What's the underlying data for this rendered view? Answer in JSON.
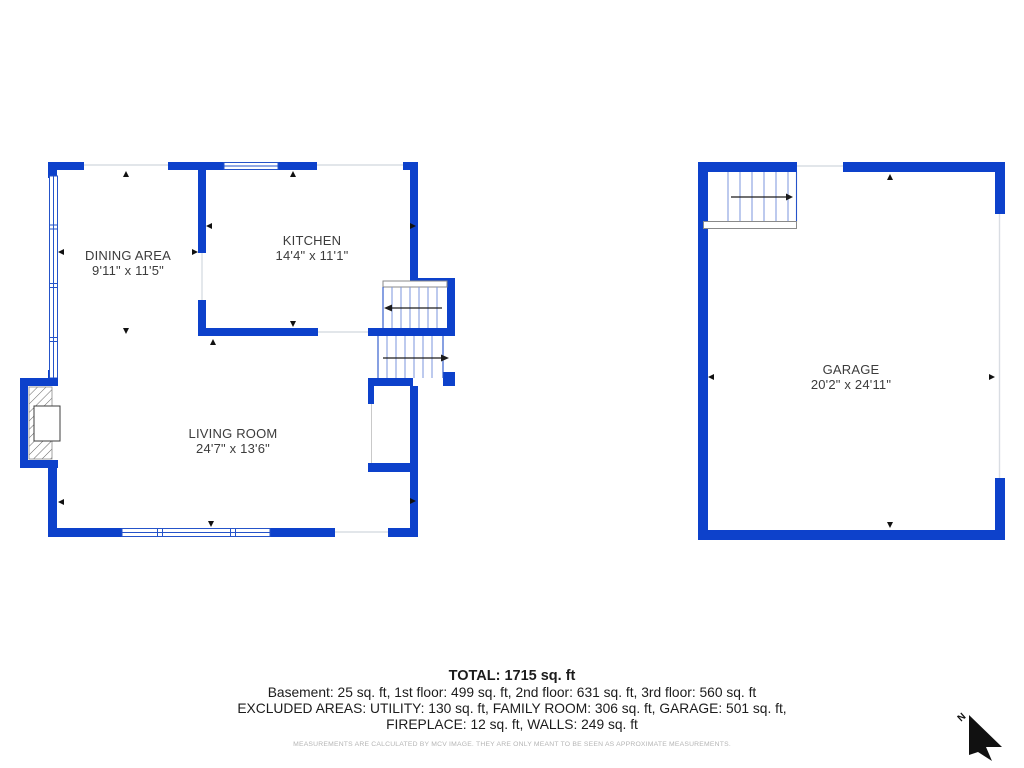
{
  "colors": {
    "wall": "#0d41cb",
    "windowline": "#2553c9",
    "tread": "#7b96dd",
    "openline": "#d9dde3",
    "stairarrow": "#1c1c1c",
    "roomtext": "#3c3c3c",
    "summarytext": "#1c1c1c",
    "disclaimertext": "#b5b5b5",
    "compasscolor": "#111111"
  },
  "rooms": {
    "dining": {
      "name": "DINING AREA",
      "dims": "9'11\" x 11'5\""
    },
    "kitchen": {
      "name": "KITCHEN",
      "dims": "14'4\" x 11'1\""
    },
    "living": {
      "name": "LIVING ROOM",
      "dims": "24'7\" x 13'6\""
    },
    "garage": {
      "name": "GARAGE",
      "dims": "20'2\" x 24'11\""
    }
  },
  "summary": {
    "total": "TOTAL: 1715 sq. ft",
    "floors": "Basement: 25 sq. ft, 1st floor: 499 sq. ft, 2nd floor: 631 sq. ft, 3rd floor: 560 sq. ft",
    "excluded1": "EXCLUDED AREAS: UTILITY: 130 sq. ft, FAMILY ROOM: 306 sq. ft, GARAGE: 501 sq. ft,",
    "excluded2": "FIREPLACE: 12 sq. ft, WALLS: 249 sq. ft",
    "disclaimer": "MEASUREMENTS ARE CALCULATED BY MCV IMAGE. THEY ARE ONLY MEANT TO BE SEEN AS APPROXIMATE MEASUREMENTS."
  },
  "compass": {
    "label": "N"
  }
}
